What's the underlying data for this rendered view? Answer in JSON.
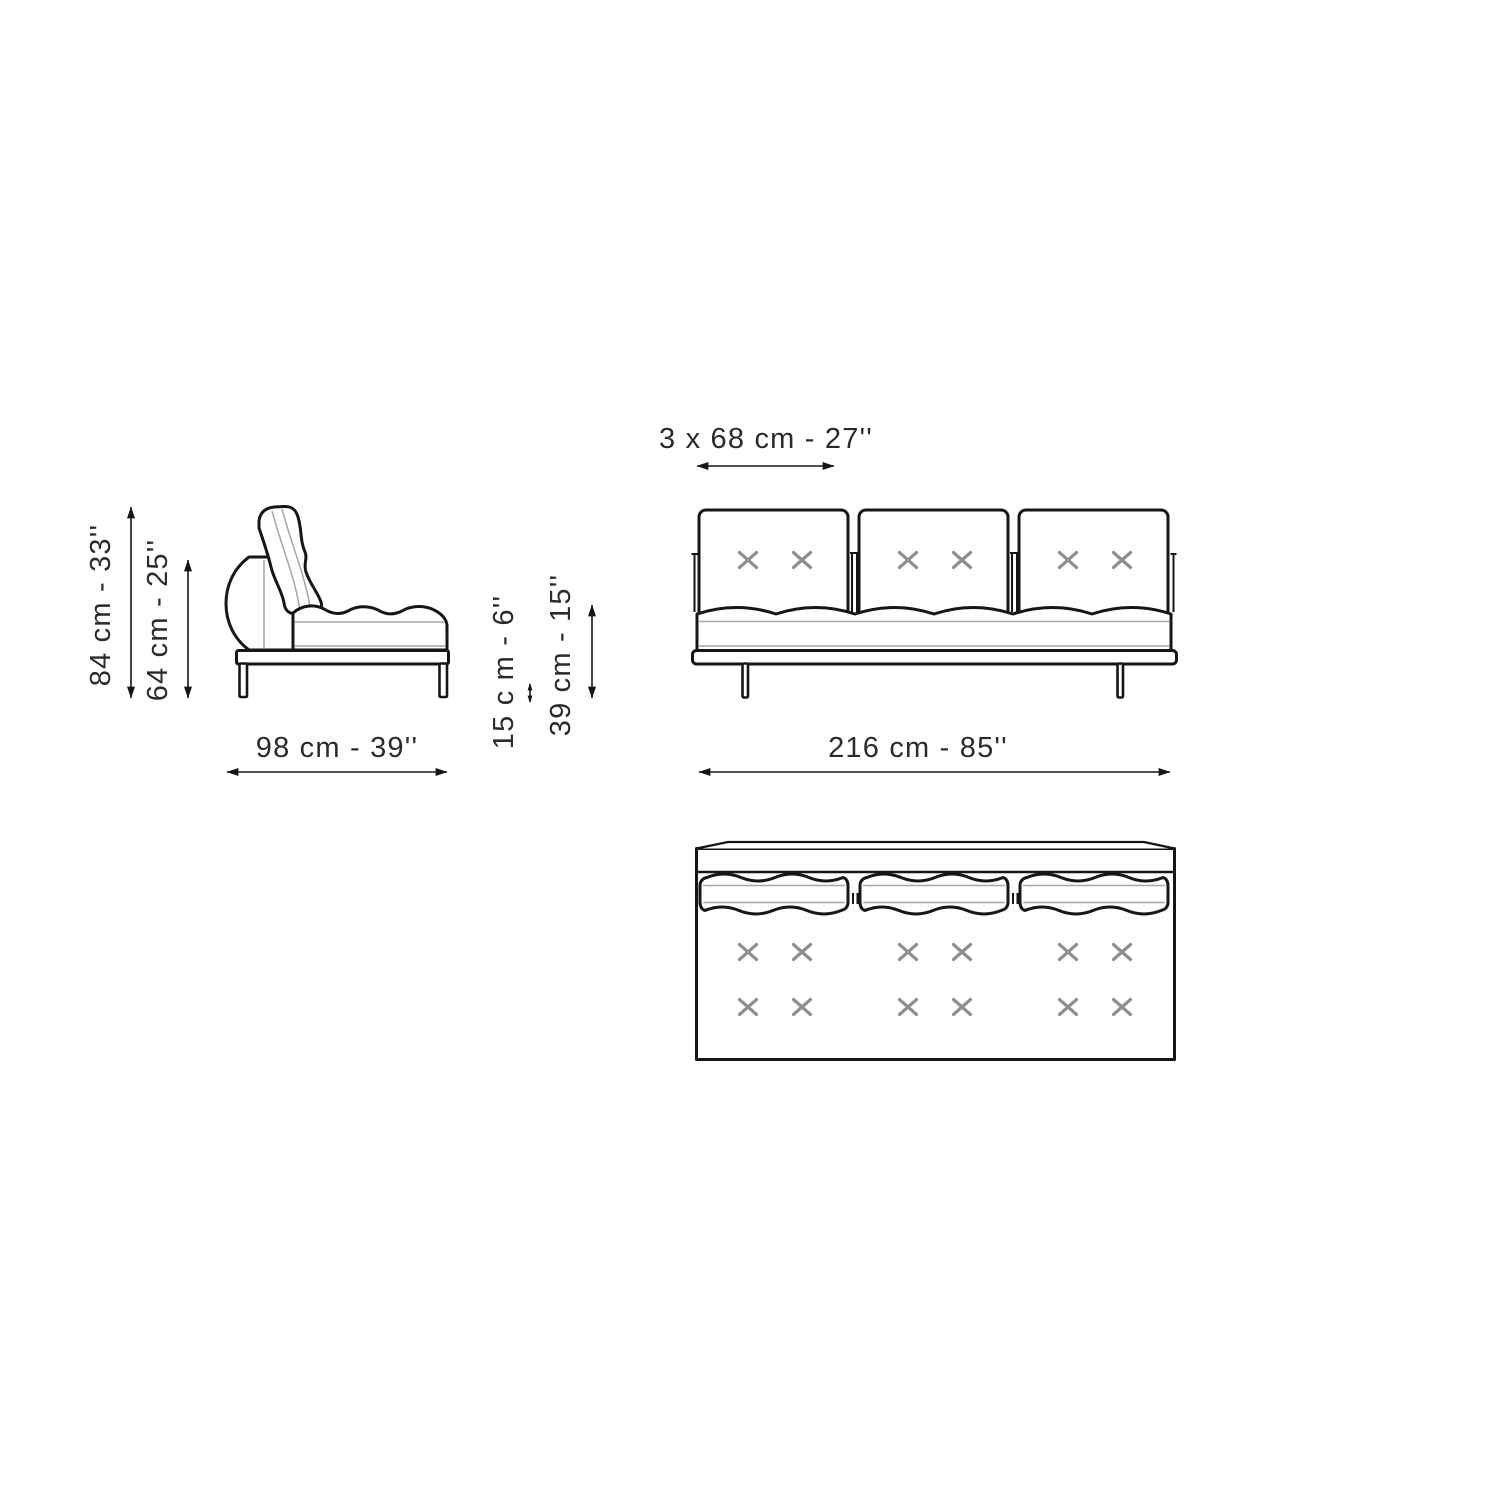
{
  "page": {
    "background": "#ffffff",
    "kind": "furniture dimension drawing"
  },
  "colors": {
    "line": "#161616",
    "stitch_gray": "#8f8f8f",
    "seam_gray": "#a6a6a6",
    "label_text": "#2b2b2b"
  },
  "labels": {
    "overall_height": "84 cm - 33''",
    "back_height": "64 cm - 25''",
    "depth": "98 cm - 39''",
    "base_height": "15 c m - 6''",
    "seat_height": "39 cm - 15''",
    "seat_module_width": "3 x 68 cm - 27''",
    "overall_width": "216 cm - 85''"
  },
  "icons": {
    "stitch_x": "x-cross stitch mark",
    "dimension_arrow": "double-headed measurement arrow"
  }
}
